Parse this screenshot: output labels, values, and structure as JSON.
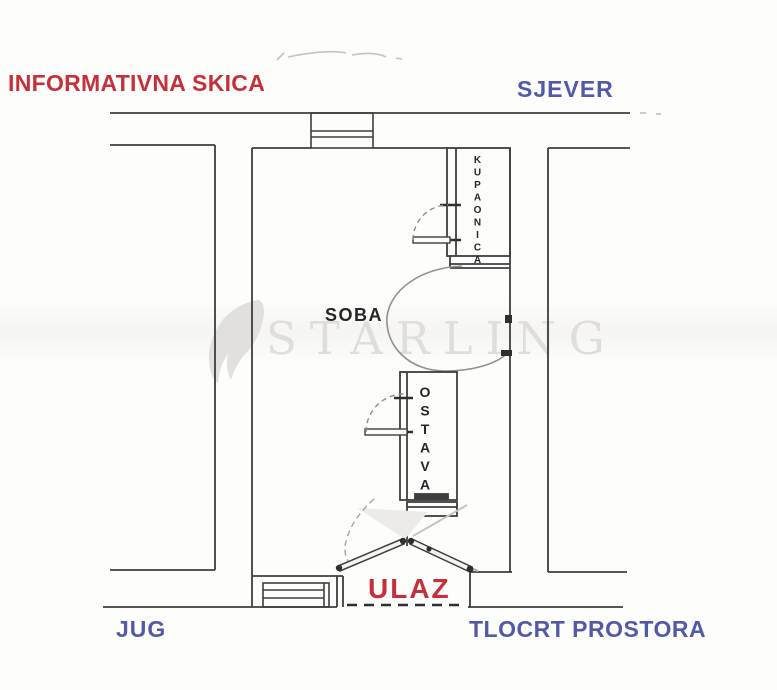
{
  "header": {
    "title": "INFORMATIVNA SKICA"
  },
  "compass": {
    "north_label": "SJEVER",
    "south_label": "JUG"
  },
  "plan": {
    "caption": "TLOCRT PROSTORA"
  },
  "rooms": {
    "living": {
      "label": "SOBA"
    },
    "bathroom": {
      "label": "KUPAONICA"
    },
    "storage": {
      "label": "OSTAVA"
    }
  },
  "entrance": {
    "label": "ULAZ"
  },
  "watermark": {
    "brand": "STARLING"
  },
  "colors": {
    "accent_red": "#c5303b",
    "accent_blue": "#525aa8",
    "wall_line": "#3e3e3e",
    "watermark_gray": "#e0deda",
    "background": "#fdfdfc"
  }
}
